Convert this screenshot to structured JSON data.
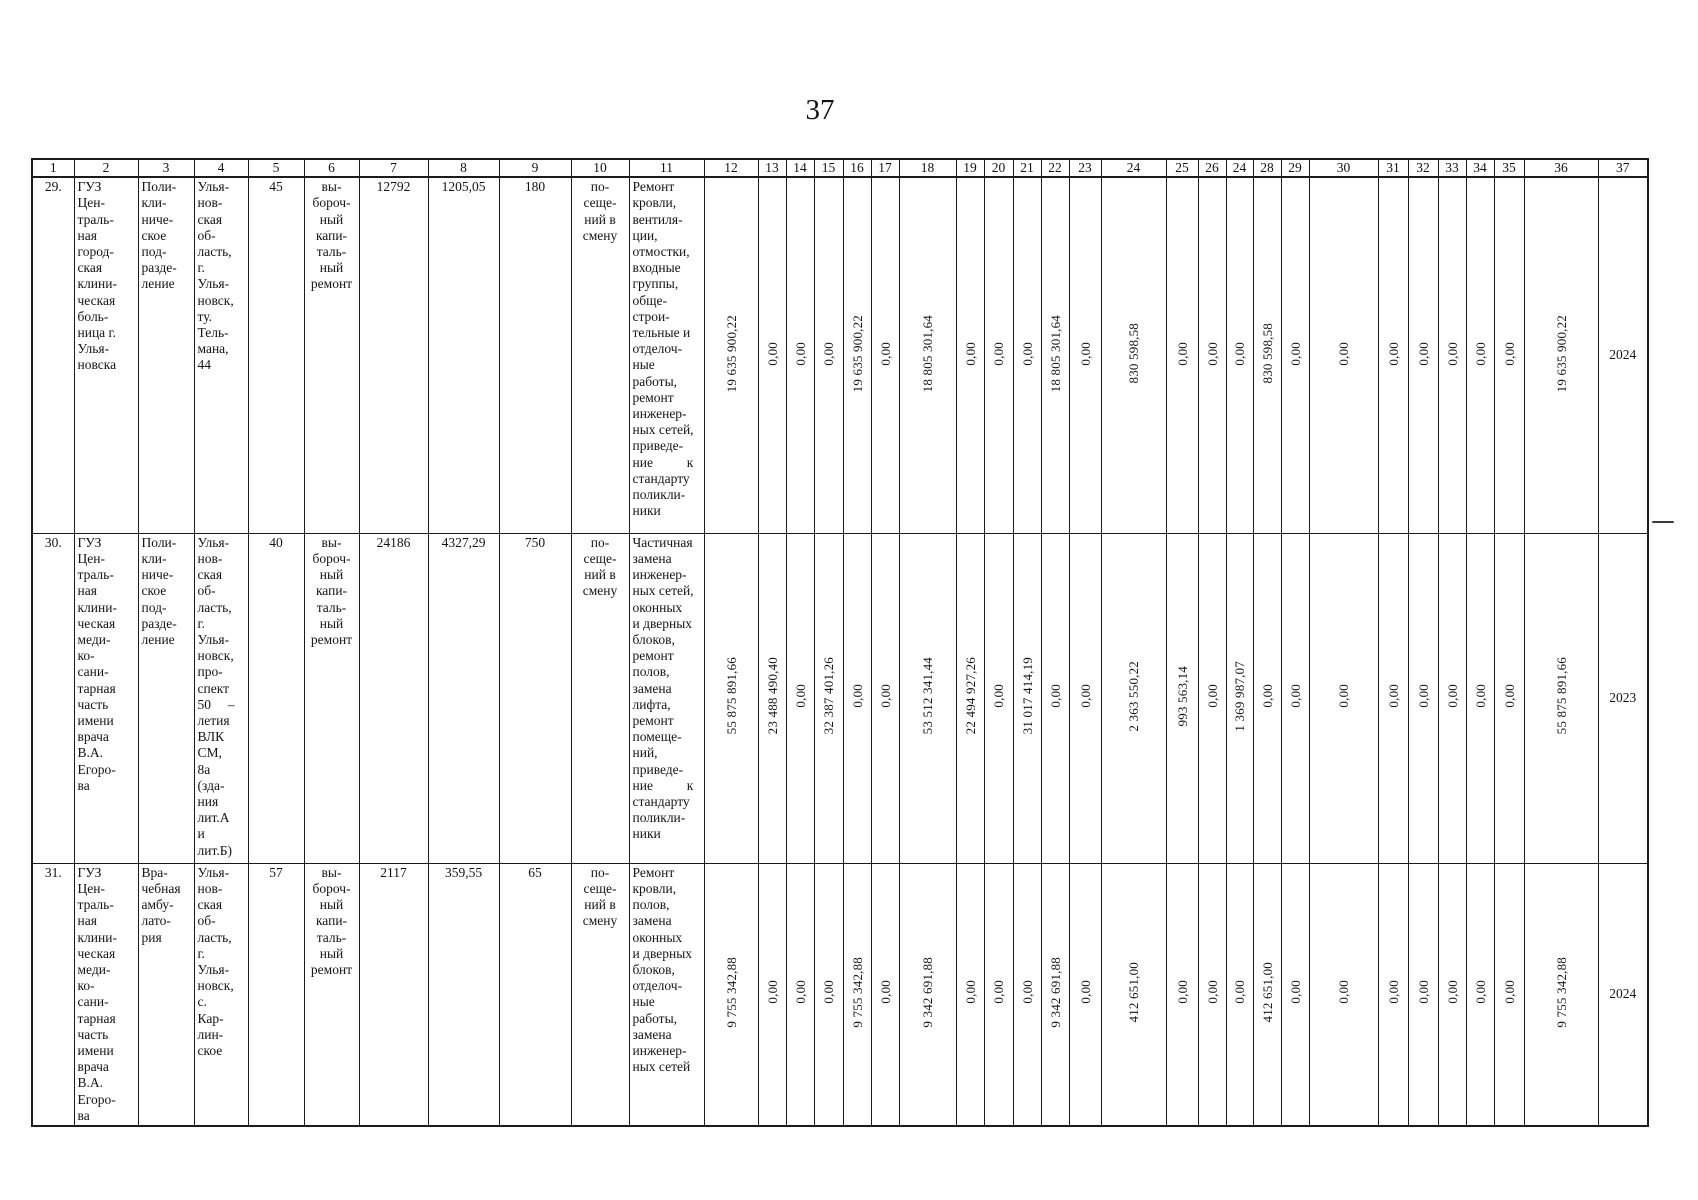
{
  "page": {
    "number": "37"
  },
  "colors": {
    "ink": "#1b1b1b",
    "paper": "#ffffff"
  },
  "table": {
    "header_labels": [
      "1",
      "2",
      "3",
      "4",
      "5",
      "6",
      "7",
      "8",
      "9",
      "10",
      "11",
      "12",
      "13",
      "14",
      "15",
      "16",
      "17",
      "18",
      "19",
      "20",
      "21",
      "22",
      "23",
      "24",
      "25",
      "26",
      "24",
      "28",
      "29",
      "30",
      "31",
      "32",
      "33",
      "34",
      "35",
      "36",
      "37"
    ],
    "rows": [
      {
        "no": "29.",
        "name": "ГУЗ\nЦен-\nтраль-\nная\nгород-\nская\nклини-\nческая\nболь-\nница г.\nУлья-\nновска",
        "subdivision": "Поли-\nкли-\nниче-\nское\nпод-\nразде-\nление",
        "address": "Улья-\nнов-\nская\nоб-\nласть,\nг.\nУлья-\nновск,\nту.\nТель-\nмана,\n44",
        "area": "45",
        "repair_type": "вы-\nбороч-\nный\nкапи-\nталь-\nный\nремонт",
        "capacity": "12792",
        "estimated_cost": "1205,05",
        "visits": "180",
        "unit": "по-\nсеще-\nний в\nсмену",
        "works": "Ремонт\nкровли,\nвентиля-\nции,\nотмостки,\nвходные\nгруппы,\nобще-\nстрои-\nтельные и\nотделоч-\nные\nработы,\nремонт\nинженер-\nных сетей,\nприведе-\nние          к\nстандарту\nполикли-\nники",
        "values": [
          "19 635 900,22",
          "0,00",
          "0,00",
          "0,00",
          "19 635 900,22",
          "0,00",
          "18 805 301,64",
          "0,00",
          "0,00",
          "0,00",
          "18 805 301,64",
          "0,00",
          "830 598,58",
          "0,00",
          "0,00",
          "0,00",
          "830 598,58",
          "0,00",
          "0,00",
          "0,00",
          "0,00",
          "0,00",
          "0,00",
          "0,00",
          "19 635 900,22",
          "2024"
        ]
      },
      {
        "no": "30.",
        "name": "ГУЗ\nЦен-\nтраль-\nная\nклини-\nческая\nмеди-\nко-\nсани-\nтарная\nчасть\nимени\nврача\nВ.А.\nЕгоро-\nва",
        "subdivision": "Поли-\nкли-\nниче-\nское\nпод-\nразде-\nление",
        "address": "Улья-\nнов-\nская\nоб-\nласть,\nг.\nУлья-\nновск,\nпро-\nспект\n50     –\nлетия\nВЛК\nСМ,\n8а\n(зда-\nния\nлит.А\nи\nлит.Б)",
        "area": "40",
        "repair_type": "вы-\nбороч-\nный\nкапи-\nталь-\nный\nремонт",
        "capacity": "24186",
        "estimated_cost": "4327,29",
        "visits": "750",
        "unit": "по-\nсеще-\nний в\nсмену",
        "works": "Частичная\nзамена\nинженер-\nных сетей,\nоконных\nи дверных\nблоков,\nремонт\nполов,\nзамена\nлифта,\nремонт\nпомеще-\nний,\nприведе-\nние          к\nстандарту\nполикли-\nники",
        "values": [
          "55 875 891,66",
          "23 488 490,40",
          "0,00",
          "32 387 401,26",
          "0,00",
          "0,00",
          "53 512 341,44",
          "22 494 927,26",
          "0,00",
          "31 017 414,19",
          "0,00",
          "0,00",
          "2 363 550,22",
          "993 563,14",
          "0,00",
          "1 369 987,07",
          "0,00",
          "0,00",
          "0,00",
          "0,00",
          "0,00",
          "0,00",
          "0,00",
          "0,00",
          "55 875 891,66",
          "2023"
        ]
      },
      {
        "no": "31.",
        "name": "ГУЗ\nЦен-\nтраль-\nная\nклини-\nческая\nмеди-\nко-\nсани-\nтарная\nчасть\nимени\nврача\nВ.А.\nЕгоро-\nва",
        "subdivision": "Вра-\nчебная\nамбу-\nлато-\nрия",
        "address": "Улья-\nнов-\nская\nоб-\nласть,\nг.\nУлья-\nновск,\nс.\nКар-\nлин-\nское",
        "area": "57",
        "repair_type": "вы-\nбороч-\nный\nкапи-\nталь-\nный\nремонт",
        "capacity": "2117",
        "estimated_cost": "359,55",
        "visits": "65",
        "unit": "по-\nсеще-\nний в\nсмену",
        "works": "Ремонт\nкровли,\nполов,\nзамена\nоконных\nи дверных\nблоков,\nотделоч-\nные\nработы,\nзамена\nинженер-\nных сетей",
        "values": [
          "9 755 342,88",
          "0,00",
          "0,00",
          "0,00",
          "9 755 342,88",
          "0,00",
          "9 342 691,88",
          "0,00",
          "0,00",
          "0,00",
          "9 342 691,88",
          "0,00",
          "412 651,00",
          "0,00",
          "0,00",
          "0,00",
          "412 651,00",
          "0,00",
          "0,00",
          "0,00",
          "0,00",
          "0,00",
          "0,00",
          "0,00",
          "9 755 342,88",
          "2024"
        ]
      }
    ]
  }
}
